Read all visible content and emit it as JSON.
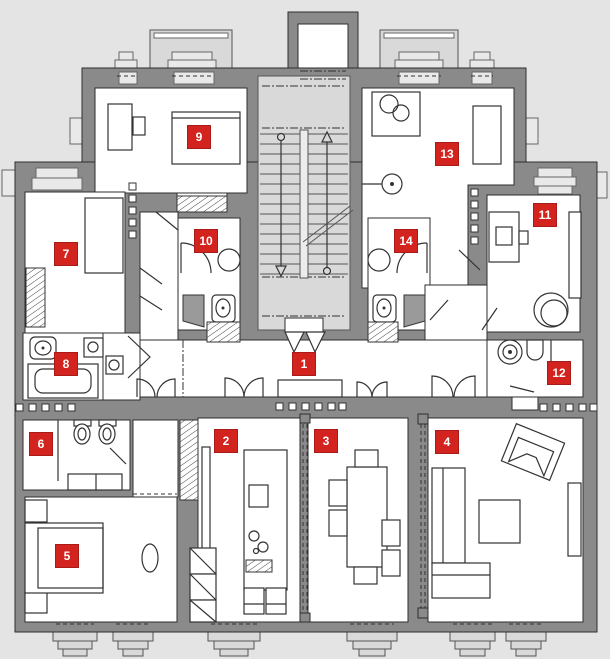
{
  "figure": {
    "kind": "apartment floor plan",
    "room_count": 14
  },
  "colors": {
    "background": "#e4e4e4",
    "wall_gray": "#8a8a8a",
    "room_fill": "#ffffff",
    "stair_fill": "#d9d9d9",
    "outline": "#2e2e2e",
    "label_background": "#d3231f",
    "label_text": "#ffffff"
  },
  "rooms": [
    {
      "number": "1"
    },
    {
      "number": "2"
    },
    {
      "number": "3"
    },
    {
      "number": "4"
    },
    {
      "number": "5"
    },
    {
      "number": "6"
    },
    {
      "number": "7"
    },
    {
      "number": "8"
    },
    {
      "number": "9"
    },
    {
      "number": "10"
    },
    {
      "number": "11"
    },
    {
      "number": "12"
    },
    {
      "number": "13"
    },
    {
      "number": "14"
    }
  ]
}
